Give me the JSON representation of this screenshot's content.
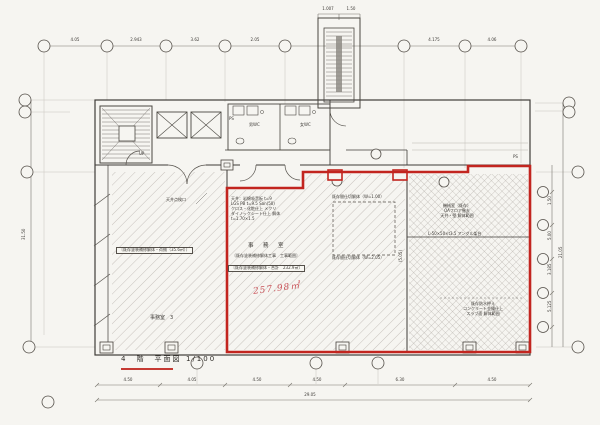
{
  "title": {
    "floor": "4　階　平面図",
    "scale": "1/100"
  },
  "core": {
    "stair_label": "UP",
    "ps": "PS",
    "ps_right": "PS",
    "wc_men": "男WC",
    "wc_women": "女WC"
  },
  "left_room": {
    "scope_box": "〔既存塗装補修解体・荷揃（35.6㎡）〕",
    "name": "事務室　3",
    "ceiling_note": "天井点検口"
  },
  "office": {
    "name": "事　務　室",
    "scope_note": "〔既存塗装補修解体工事　工事範囲〕",
    "total_box": "〔既存塗装補修解体・合計　232.9㎡〕",
    "handwritten_area": "257.98㎡",
    "spec_lines": [
      "天井：岩綿吸音板 t=9",
      "LGS PB t=9.5 San(50)",
      "クロス・化粧仕上 メクリ",
      "ダイノックシート仕上 解体",
      "t=1.70×1.5"
    ]
  },
  "partition": {
    "upper_note": "既存間仕切解体（W=1.00）",
    "lower_note": "既存間仕切解体（W=2.05）"
  },
  "machine_room": {
    "labels": [
      "機械室（既存）",
      "OAフロア撤去",
      "天井・壁 解体範囲"
    ],
    "angle_note": "L-50×50×t3.5 アングル架台",
    "south_labels": [
      "既存防水押え",
      "コンクリート金鏝仕上",
      "スラブ面 解体範囲"
    ]
  },
  "dims": {
    "top": [
      "4.05",
      "2.943",
      "3.62",
      "2.05",
      "4.175",
      "4.06"
    ],
    "tower": [
      "1.007",
      "1.50"
    ],
    "bottom": [
      "4.50",
      "4.05",
      "4.50",
      "4.50",
      "6.30",
      "4.50"
    ],
    "bottom_total": "29.05",
    "left_total": "31.50",
    "right_segments": [
      "1.50",
      "5.00",
      "3.185",
      "5.125"
    ],
    "right_total": "21.05",
    "inner_width": "(5.05)"
  },
  "colors": {
    "highlight_red": "#c2251f",
    "handwriting_red": "#c9545a",
    "line": "#3f3c38",
    "paper": "#f6f5f1"
  }
}
